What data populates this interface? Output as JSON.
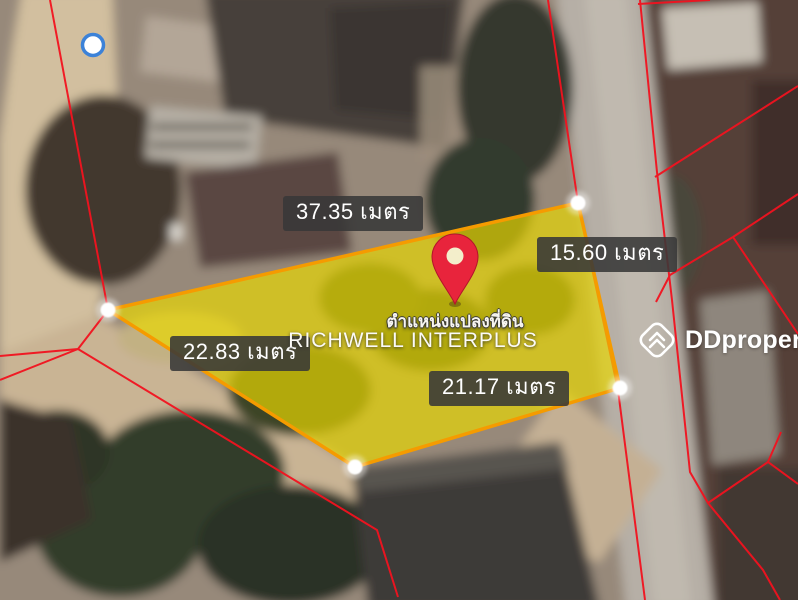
{
  "map": {
    "kind": "satellite-property-plot-map",
    "plot": {
      "caption_line1": "ตำแหน่งแปลงที่ดิน",
      "caption_line2": "RICHWELL INTERPLUS",
      "unit": "เมตร",
      "edge_labels": {
        "top": "37.35 เมตร",
        "right": "15.60 เมตร",
        "left": "22.83 เมตร",
        "bottom": "21.17 เมตร"
      },
      "edge_lengths_m": {
        "top": 37.35,
        "right": 15.6,
        "left": 22.83,
        "bottom": 21.17
      },
      "vertex_count": 4
    },
    "markers": {
      "pin": "red-location-pin",
      "vertices": "white-dot-vertex-markers",
      "poi": "blue-ring-marker"
    },
    "colors": {
      "plot_fill": "#e9d600",
      "plot_border": "#f59b00",
      "parcel_lines": "#f2121f",
      "pin": "#e8243c",
      "label_bg": "#383838",
      "label_text": "#ffffff",
      "poi_ring": "#3c82d8"
    }
  },
  "watermark": {
    "brand": "DDproperty",
    "icon": "ddproperty-chevron-diamond-icon"
  }
}
